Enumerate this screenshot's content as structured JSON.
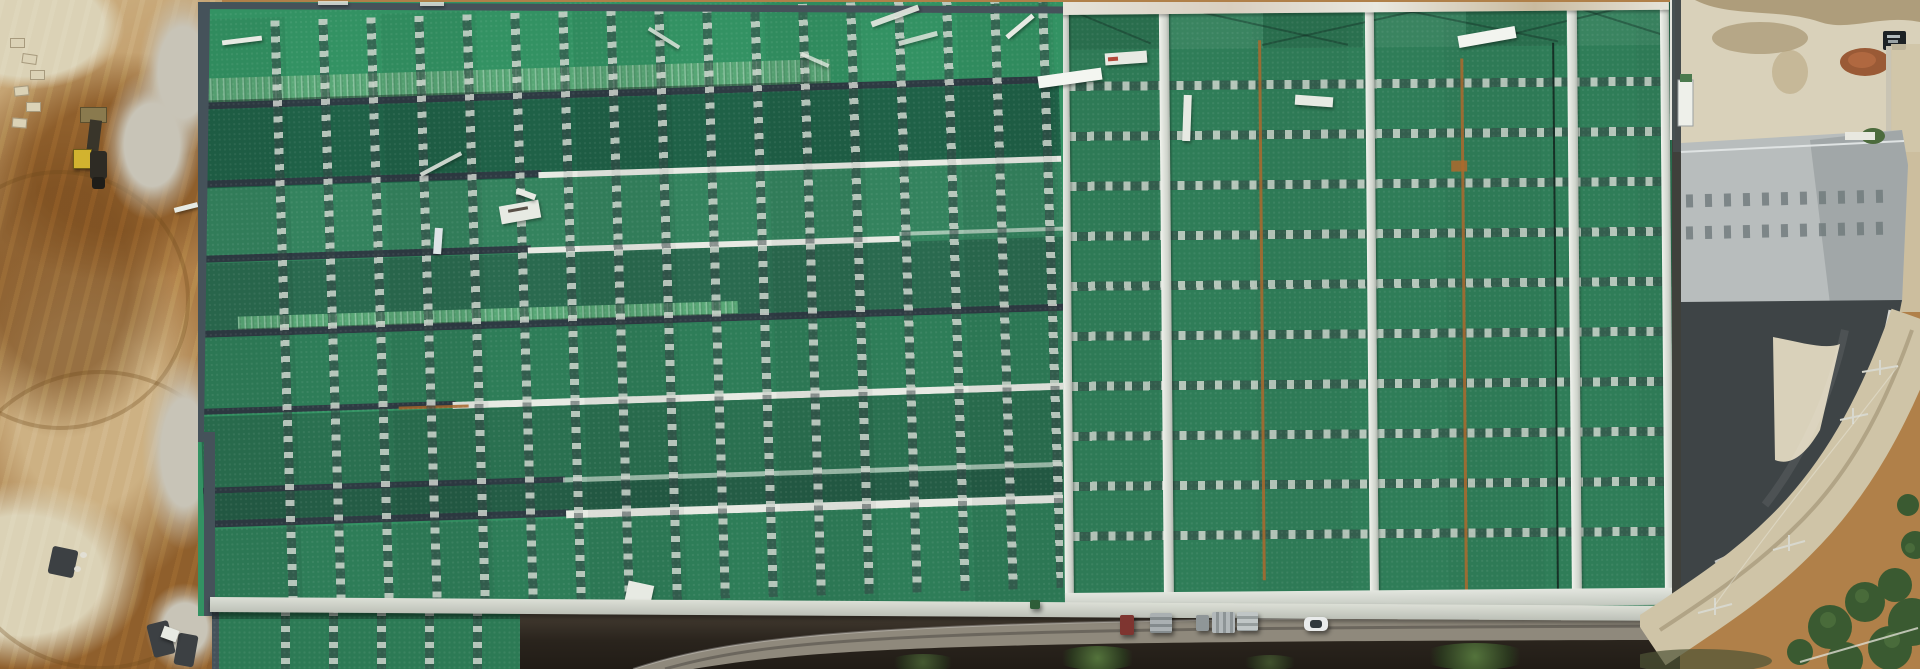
{
  "meta": {
    "title": "Aerial drone photograph — industrial buildings with green metal roofs beside an earthworks site",
    "domain": "Natural-Image",
    "description": "Top-down aerial view. Left: brown excavated dirt with a yellow wheel loader and rubble. Center: large green sawtooth warehouse roof with rows of skylight strips (vertical dashed gray lines), dark ridge lines and white maintenance walkways. Right of center: second green roof with vertical white ridge cappings, rust seam lines and horizontal dashed skylight bands. Far right: concrete yard with parked truck, gray gabled building, dark charcoal curved roof, curved beige road, power poles and trees. Bottom: service road with parked vehicles (red box truck, gray pallet stacks, white car) and dark vegetated slope."
  },
  "palette": {
    "dirt_base": "#b08049",
    "dirt_dark": "#8f5f2c",
    "dirt_light": "#cdb183",
    "dirt_pale": "#dbd2b6",
    "rubble": "#c8c4b7",
    "slate": "#45525a",
    "ridge_dark": "#2e3b43",
    "green_bright": "#339263",
    "green_dark": "#1f6147",
    "green_mid": "#34835e",
    "green_mid2": "#2e7d58",
    "green_middark": "#2a7050",
    "green_teal": "#2a6a4f",
    "green_dark2": "#245c45",
    "green_corr": "#58a776",
    "green_right": "#2f7d58",
    "green_ext": "#2c7a55",
    "white_walk": "#e7eae3",
    "eave_light": "#ccd1c8",
    "dash_light": "#cdd3cc",
    "rust": "#ad6a2d",
    "pad": "#d9d1ba",
    "stain": "#a3906c",
    "gray_roof": "#b8bdbd",
    "gray_roof_dark": "#8e9697",
    "charcoal": "#3e4446",
    "road": "#cfc4a7",
    "tree": "#3a5a31",
    "bottom_dark": "#2a241d",
    "road_low": "#8f897c",
    "truck_red": "#7e3530",
    "car_white": "#e9ebeb",
    "metal_gray": "#9ba1a3",
    "excv_yellow": "#d2b32f"
  },
  "objects": [
    {
      "name": "excavated-dirt-area",
      "position": "left strip",
      "color": "#b08049"
    },
    {
      "name": "wheel-loader",
      "position": "left, upper",
      "color": "#d2b32f"
    },
    {
      "name": "warehouse-roof-west",
      "position": "center-left",
      "color": "#2e7d58",
      "features": [
        "sawtooth bands",
        "vertical skylight dash strips",
        "white walkways",
        "loose white metal sheets"
      ]
    },
    {
      "name": "warehouse-roof-east",
      "position": "center-right",
      "color": "#2f7d58",
      "features": [
        "white vertical ridge caps",
        "horizontal skylight dash bands",
        "rust seam lines",
        "rust-stained white eave"
      ]
    },
    {
      "name": "concrete-yard",
      "position": "far right top",
      "color": "#d9d1ba",
      "features": [
        "wet stains",
        "dark truck",
        "red-brown debris pile"
      ]
    },
    {
      "name": "gray-gabled-building",
      "position": "far right middle",
      "color": "#b8bdbd"
    },
    {
      "name": "charcoal-curved-roof",
      "position": "far right lower",
      "color": "#3e4446"
    },
    {
      "name": "curved-road",
      "position": "far right",
      "color": "#cfc4a7"
    },
    {
      "name": "trees",
      "position": "bottom right",
      "color": "#3a5a31"
    },
    {
      "name": "service-road-vehicles",
      "position": "bottom center",
      "items": [
        "red box truck",
        "gray pallet stacks",
        "white car",
        "green bin"
      ]
    }
  ]
}
